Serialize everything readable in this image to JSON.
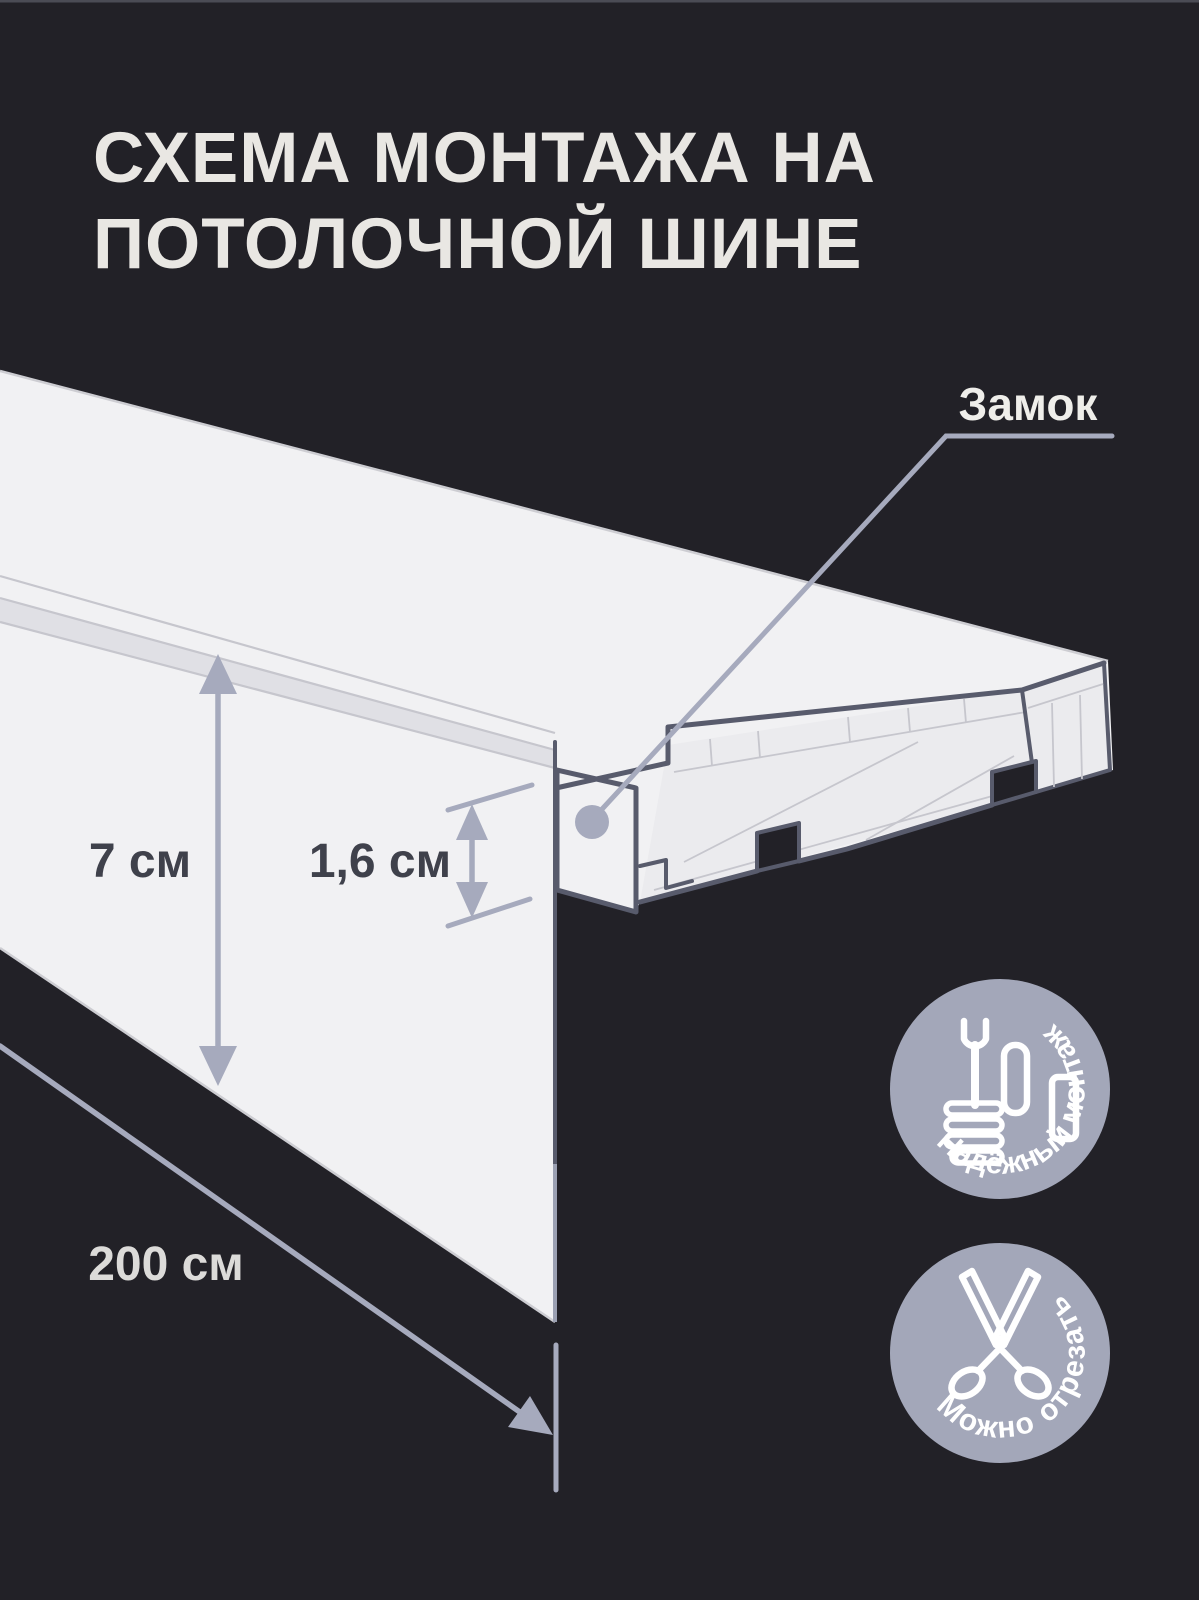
{
  "title": {
    "line1": "СХЕМА МОНТАЖА НА",
    "line2": "ПОТОЛОЧНОЙ ШИНЕ"
  },
  "callout": {
    "label": "Замок"
  },
  "dimensions": {
    "height_label": "7 см",
    "profile_label": "1,6 см",
    "length_label": "200 см"
  },
  "badges": [
    {
      "label": "Надёжный монтаж",
      "icon": "wrench-thumbs-up-icon"
    },
    {
      "label": "Можно отрезать",
      "icon": "scissors-icon"
    }
  ],
  "colors": {
    "background": "#222127",
    "surface": "#f1f1f3",
    "surface_shaded": "#ebebee",
    "surface_groove": "#e0e0e5",
    "outline": "#585b6c",
    "accent": "#a6aabd",
    "line_faint": "#c6c6cd",
    "label_dark": "#3f414b",
    "label_light": "#e9e7e3",
    "badge_fill": "#a3a7b9",
    "icon_white": "#ffffff",
    "edge_soft": "#9ba0b2"
  }
}
